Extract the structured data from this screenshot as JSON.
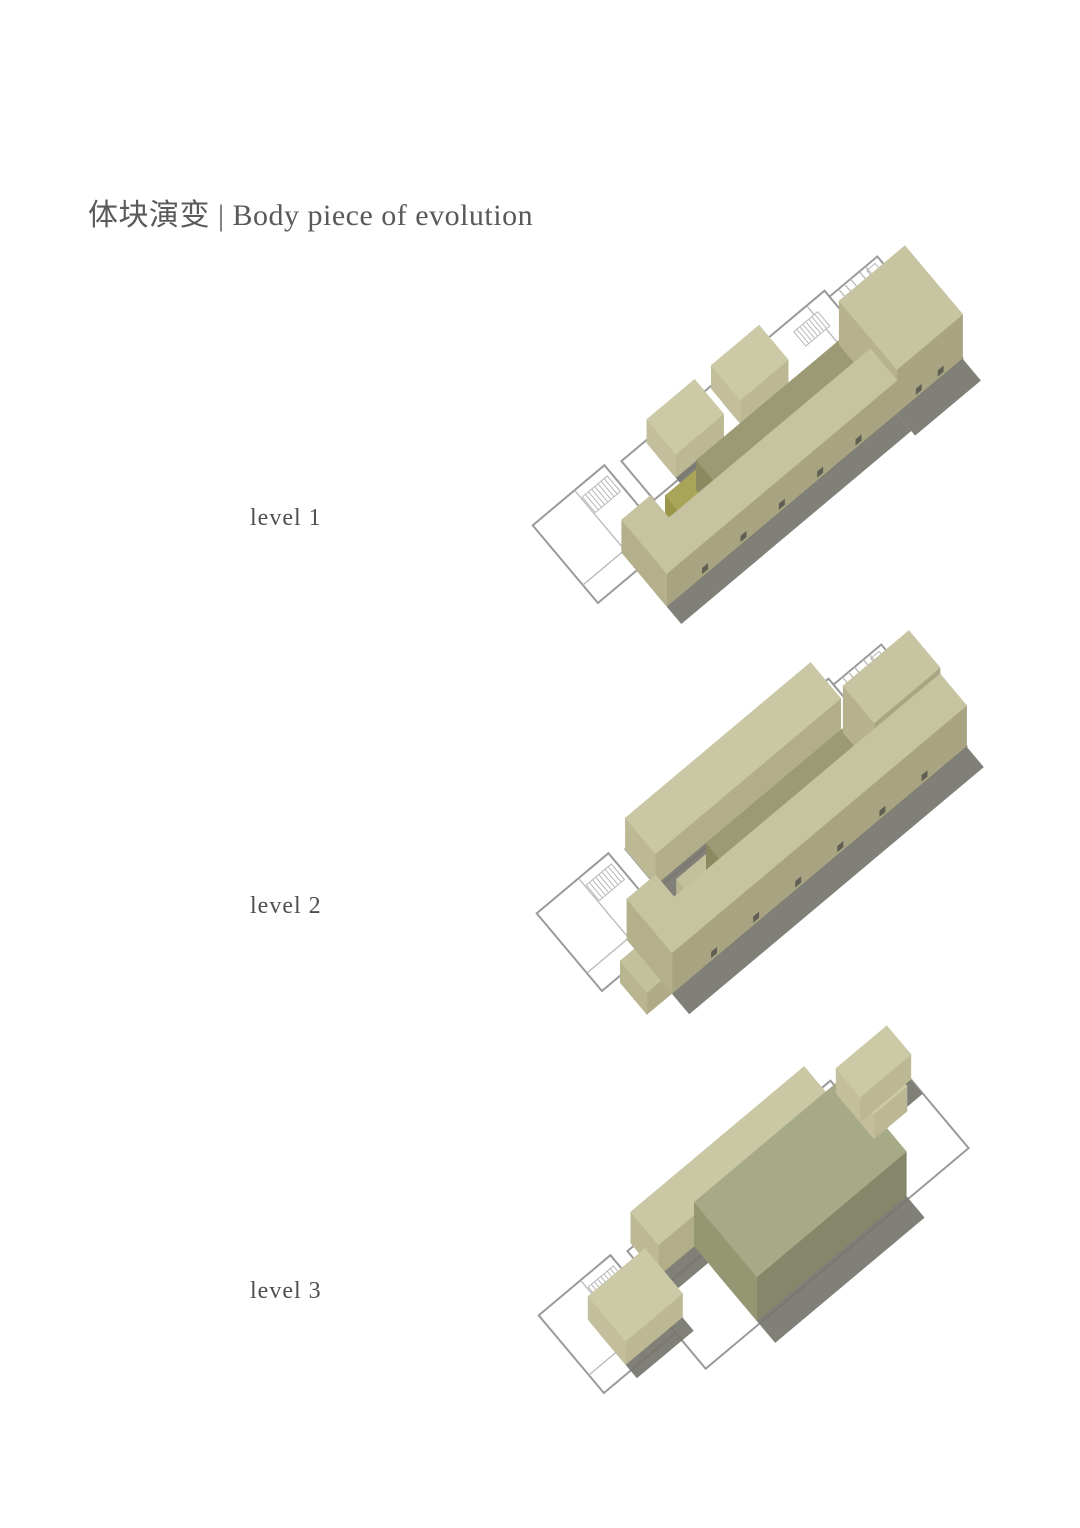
{
  "title": {
    "text": "体块演变 | Body piece of evolution",
    "color": "#595959"
  },
  "label_color": "#4f4f4f",
  "levels": [
    {
      "label": "level 1",
      "label_pos": {
        "left": 250,
        "top": 505
      },
      "transform": {
        "tx": 642,
        "ty": 510,
        "scale": 0.78,
        "angle": -40
      },
      "blocks": [
        {
          "name": "small-box-a",
          "x": 60,
          "y": -62,
          "w": 80,
          "h": 58,
          "z": 30,
          "top": "#ccc9a6",
          "se": "#bcb893",
          "sw": "#c3bf9c",
          "shadow": true,
          "doors": 0
        },
        {
          "name": "small-box-b",
          "x": 168,
          "y": -62,
          "w": 80,
          "h": 58,
          "z": 30,
          "top": "#ccc9a6",
          "se": "#bcb893",
          "sw": "#c3bf9c",
          "shadow": true,
          "doors": 0
        },
        {
          "name": "bar-end-block",
          "x": 18,
          "y": 25,
          "w": 52,
          "h": 45,
          "z": 26,
          "top": "#a8a458",
          "se": "#908d45",
          "sw": "#999649",
          "shadow": false,
          "doors": 0
        },
        {
          "name": "central-bar",
          "x": 70,
          "y": 25,
          "w": 250,
          "h": 45,
          "z": 38,
          "top": "#9b9a74",
          "se": "#7d7c56",
          "sw": "#8a8960",
          "shadow": true,
          "doors": 0
        },
        {
          "name": "ne-head-block",
          "x": 330,
          "y": 0,
          "w": 110,
          "h": 115,
          "z": 56,
          "top": "#c7c4a1",
          "se": "#a9a583",
          "sw": "#b6b28e",
          "shadow": true,
          "doors": 2
        },
        {
          "name": "strip-wing",
          "x": -55,
          "y": 25,
          "w": 48,
          "h": 37,
          "z": 42,
          "top": "#c6c3a0",
          "se": "#a8a482",
          "sw": "#b4b08c",
          "shadow": false,
          "doors": 0
        },
        {
          "name": "se-strip",
          "x": -55,
          "y": 62,
          "w": 385,
          "h": 53,
          "z": 42,
          "top": "#c6c3a0",
          "se": "#a8a482",
          "sw": "#b4b08c",
          "shadow": true,
          "doors": 5
        }
      ]
    },
    {
      "label": "level 2",
      "label_pos": {
        "left": 250,
        "top": 893
      },
      "transform": {
        "tx": 646,
        "ty": 898,
        "scale": 0.78,
        "angle": -40
      },
      "blocks": [
        {
          "name": "nw-bar",
          "x": 20,
          "y": -65,
          "w": 310,
          "h": 60,
          "z": 40,
          "top": "#cac7a4",
          "se": "#b2ae89",
          "sw": "#bdb995",
          "shadow": true,
          "doors": 0
        },
        {
          "name": "bar-end-block",
          "x": 30,
          "y": 25,
          "w": 50,
          "h": 45,
          "z": 24,
          "top": "#c3c09c",
          "se": "#afab87",
          "sw": "#b9b591",
          "shadow": false,
          "doors": 0
        },
        {
          "name": "central-bar",
          "x": 80,
          "y": 25,
          "w": 250,
          "h": 45,
          "z": 38,
          "top": "#9b9a74",
          "se": "#7d7c56",
          "sw": "#8a8960",
          "shadow": true,
          "doors": 0
        },
        {
          "name": "ne-head-block",
          "x": 330,
          "y": 0,
          "w": 110,
          "h": 62,
          "z": 60,
          "top": "#c7c4a1",
          "se": "#a9a583",
          "sw": "#b6b28e",
          "shadow": true,
          "doors": 1
        },
        {
          "name": "strip-end-low",
          "x": -95,
          "y": 62,
          "w": 42,
          "h": 53,
          "z": 28,
          "top": "#c3c09c",
          "se": "#afab87",
          "sw": "#b9b591",
          "shadow": false,
          "doors": 0
        },
        {
          "name": "strip-wing",
          "x": -53,
          "y": 25,
          "w": 48,
          "h": 37,
          "z": 52,
          "top": "#c6c3a0",
          "se": "#a8a482",
          "sw": "#b4b08c",
          "shadow": false,
          "doors": 0
        },
        {
          "name": "se-strip",
          "x": -53,
          "y": 62,
          "w": 493,
          "h": 53,
          "z": 52,
          "top": "#c6c3a0",
          "se": "#a8a482",
          "sw": "#b4b08c",
          "shadow": true,
          "doors": 6
        }
      ]
    },
    {
      "label": "level 3",
      "label_pos": {
        "left": 250,
        "top": 1278
      },
      "transform": {
        "tx": 648,
        "ty": 1300,
        "scale": 0.78,
        "angle": -40
      },
      "blocks": [
        {
          "name": "nw-bar",
          "x": 30,
          "y": -70,
          "w": 290,
          "h": 55,
          "z": 40,
          "top": "#cac7a4",
          "se": "#b2ae89",
          "sw": "#bdb995",
          "shadow": true,
          "doors": 0
        },
        {
          "name": "sw-box",
          "x": -75,
          "y": -30,
          "w": 95,
          "h": 75,
          "z": 30,
          "top": "#ccc9a6",
          "se": "#bcb893",
          "sw": "#c3bf9c",
          "shadow": true,
          "doors": 0
        },
        {
          "name": "big-hall-block",
          "x": 90,
          "y": -15,
          "w": 250,
          "h": 125,
          "z": 56,
          "top": "#a7aa86",
          "se": "#84876a",
          "sw": "#949771",
          "shadow": true,
          "doors": 0
        },
        {
          "name": "ne-annex-low",
          "x": 355,
          "y": 0,
          "w": 55,
          "h": 28,
          "z": 32,
          "top": "#ccc9a6",
          "se": "#bcb893",
          "sw": "#c3bf9c",
          "shadow": false,
          "doors": 0
        },
        {
          "name": "ne-annex",
          "x": 355,
          "y": -48,
          "w": 85,
          "h": 48,
          "z": 32,
          "top": "#ccc9a6",
          "se": "#bcb893",
          "sw": "#c3bf9c",
          "shadow": true,
          "doors": 0
        }
      ]
    }
  ],
  "plan": {
    "wall_color": "#9a9a9a",
    "line_color": "#b8b8b8",
    "fill": "#ffffff",
    "shadow_color": "#75756d",
    "door_color": "#54544c",
    "rects": [
      {
        "x": 0,
        "y": 0,
        "w": 440,
        "h": 115
      },
      {
        "x": 20,
        "y": -65,
        "w": 340,
        "h": 65
      },
      {
        "x": 360,
        "y": -55,
        "w": 80,
        "h": 55
      },
      {
        "x": -120,
        "y": -75,
        "w": 120,
        "h": 130
      }
    ],
    "lines": [
      [
        -50,
        -75,
        -50,
        55
      ],
      [
        -120,
        25,
        -50,
        25
      ],
      [
        385,
        -55,
        385,
        0
      ],
      [
        410,
        -55,
        410,
        0
      ],
      [
        375,
        -55,
        375,
        -38
      ],
      [
        395,
        -55,
        395,
        -38
      ],
      [
        420,
        -55,
        420,
        -38
      ],
      [
        330,
        -65,
        330,
        0
      ],
      [
        415,
        -28,
        440,
        -28
      ]
    ],
    "stairs": [
      {
        "x": -48,
        "y": -62,
        "w": 42,
        "h": 26,
        "steps": 8
      },
      {
        "x": 296,
        "y": -50,
        "w": 40,
        "h": 24,
        "steps": 8
      }
    ],
    "fixtures": [
      {
        "x": 390,
        "y": -20,
        "w": 34,
        "h": 10
      },
      {
        "x": 418,
        "y": -50,
        "w": 14,
        "h": 8
      },
      {
        "x": 346,
        "y": -14,
        "w": 66,
        "h": 9
      }
    ]
  }
}
